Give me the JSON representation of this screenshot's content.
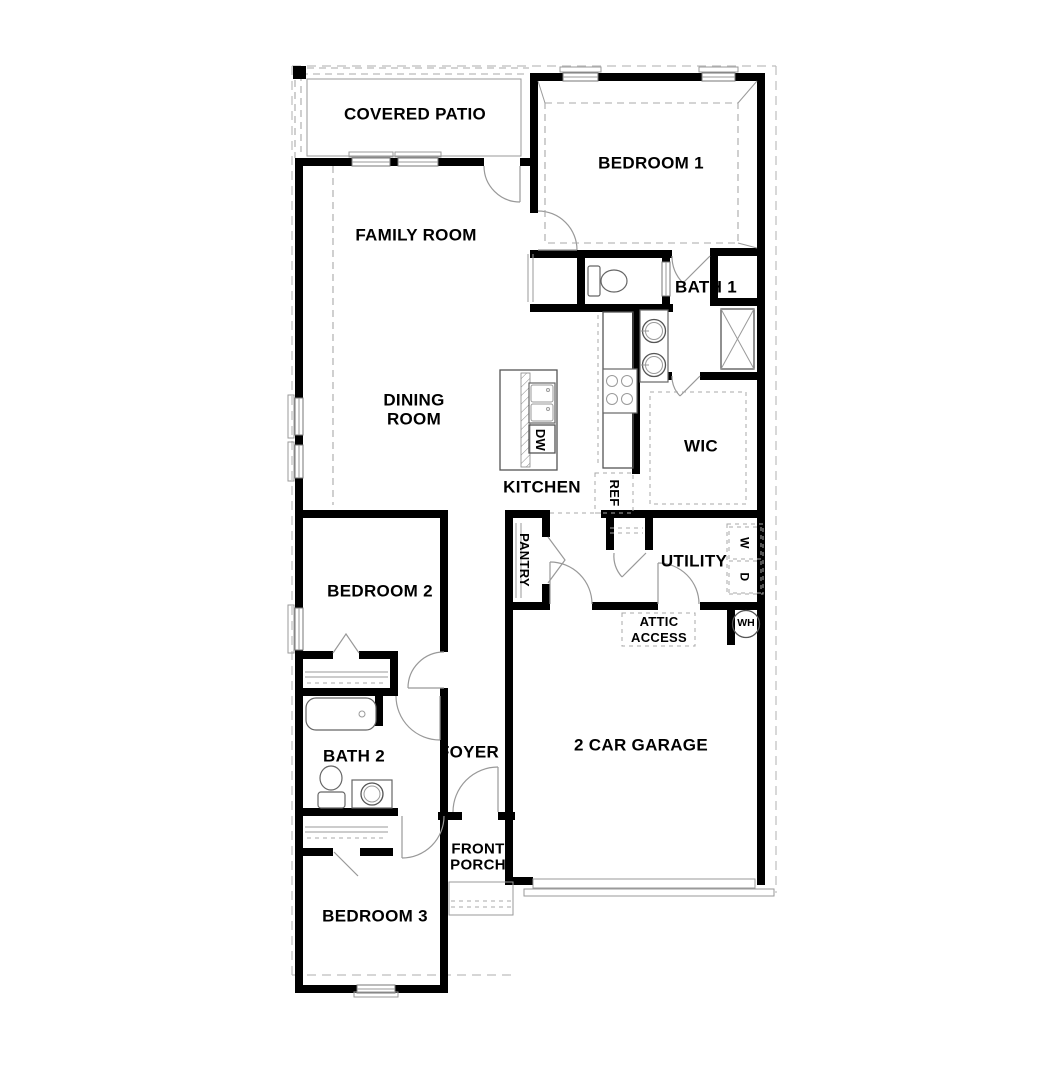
{
  "colors": {
    "wall": "#000000",
    "line": "#555555",
    "door": "#999999",
    "dash": "#a8a8a8",
    "lot": "#bdbdbd",
    "text": "#000000",
    "bg": "#ffffff"
  },
  "rooms": {
    "covered_patio": {
      "label": "COVERED PATIO"
    },
    "bedroom_1": {
      "label": "BEDROOM 1"
    },
    "family_room": {
      "label": "FAMILY ROOM"
    },
    "bath_1": {
      "label": "BATH 1"
    },
    "dining_room": {
      "label": "DINING\nROOM"
    },
    "wic": {
      "label": "WIC"
    },
    "kitchen": {
      "label": "KITCHEN"
    },
    "bedroom_2": {
      "label": "BEDROOM 2"
    },
    "utility": {
      "label": "UTILITY"
    },
    "bath_2": {
      "label": "BATH 2"
    },
    "foyer": {
      "label": "FOYER"
    },
    "garage": {
      "label": "2 CAR GARAGE"
    },
    "bedroom_3": {
      "label": "BEDROOM 3"
    },
    "front_porch": {
      "label": "FRONT\nPORCH"
    }
  },
  "fixtures": {
    "dishwasher": {
      "label": "DW"
    },
    "refrigerator": {
      "label": "REF"
    },
    "pantry": {
      "label": "PANTRY"
    },
    "washer": {
      "label": "W"
    },
    "dryer": {
      "label": "D"
    },
    "water_heater": {
      "label": "WH"
    },
    "attic_access": {
      "label": "ATTIC\nACCESS"
    }
  }
}
